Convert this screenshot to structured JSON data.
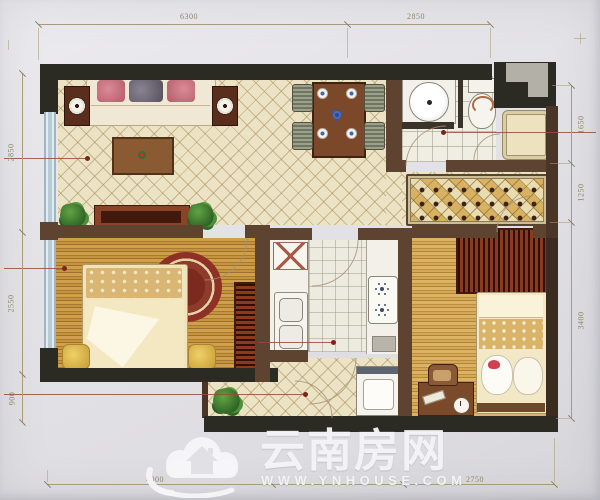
{
  "dimensions": {
    "top": [
      {
        "label": "6300"
      },
      {
        "label": "2850"
      }
    ],
    "left": [
      {
        "label": "2850"
      },
      {
        "label": "2550"
      },
      {
        "label": "900"
      }
    ],
    "right": [
      {
        "label": "1650"
      },
      {
        "label": "1250"
      },
      {
        "label": "3400"
      }
    ],
    "bottom": [
      {
        "label": "4000"
      },
      {
        "label": ""
      },
      {
        "label": "2750"
      }
    ]
  },
  "watermark": {
    "brand": "云南房网",
    "site": "WWW.YNHOUSE.COM"
  },
  "palette": {
    "paper": "#e3e2e6",
    "wall_dark": "#2b2a23",
    "wall_brown": "#5d4330",
    "floor_cream": "#ece3c4",
    "floor_wood": "#c9993f",
    "tile": "#edebdf",
    "window_blue": "#b7cbd4",
    "leader_red": "#9a4a3c",
    "dim_text": "#8f8468",
    "watermark_white": "#f3f2f5",
    "wardrobe_red": "#8a3a1f",
    "rug_red": "#8e3026"
  }
}
